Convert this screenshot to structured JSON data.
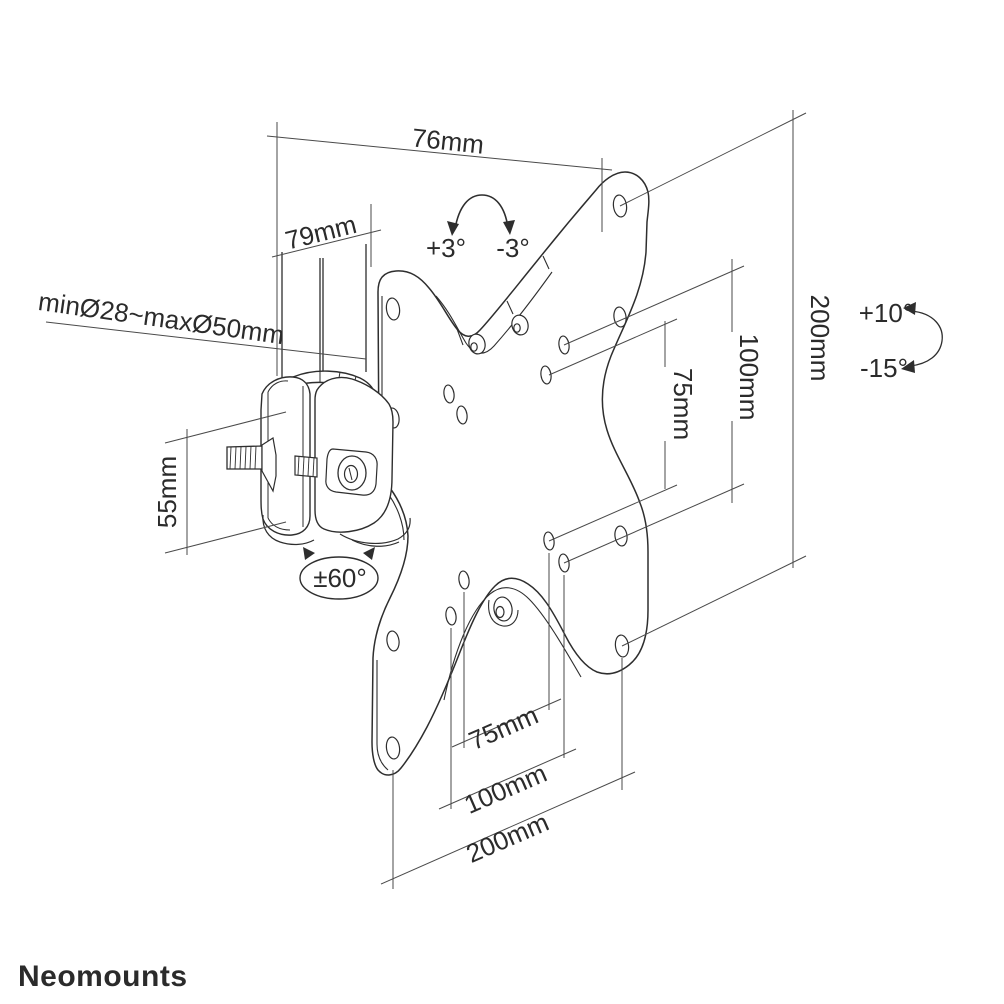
{
  "brand": {
    "logo": "Neomounts"
  },
  "drawing": {
    "labels": {
      "pole_diameter": "minØ28~maxØ50mm",
      "width_top": "76mm",
      "depth_arm": "79mm",
      "clamp_height": "55mm",
      "swivel_range": "±60°",
      "roll_plus": "+3°",
      "roll_minus": "-3°",
      "tilt_up": "+10°",
      "tilt_down": "-15°",
      "vesa_right": {
        "v75": "75mm",
        "v100": "100mm",
        "v200": "200mm"
      },
      "vesa_bottom": {
        "h75": "75mm",
        "h100": "100mm",
        "h200": "200mm"
      }
    },
    "colors": {
      "outline": "#2e2e2e",
      "dimension": "#4a4a4a",
      "brand_gray": "#8e8e8e",
      "background": "#ffffff"
    }
  }
}
